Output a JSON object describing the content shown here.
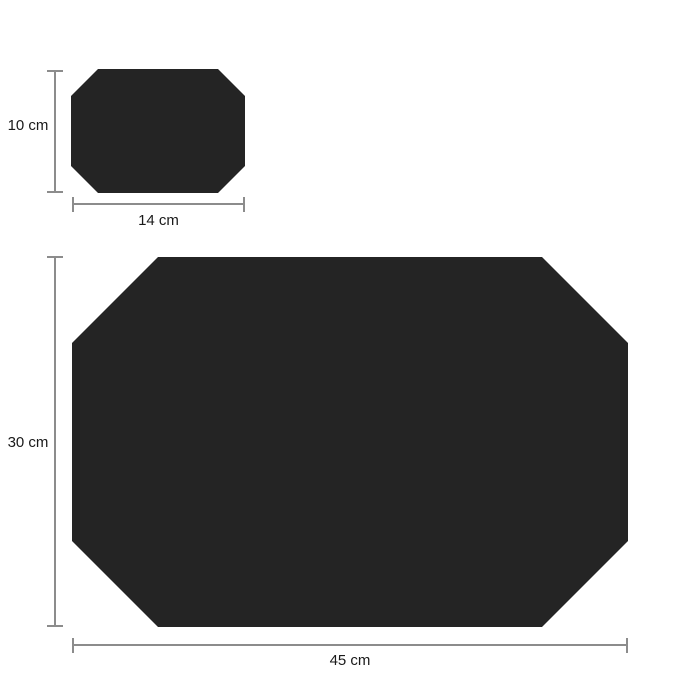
{
  "colors": {
    "background": "#ffffff",
    "shape_fill": "#242424",
    "dimension_line": "#8c8c8c",
    "label_text": "#1a1a1a"
  },
  "small_item": {
    "height_label": "10 cm",
    "width_label": "14 cm"
  },
  "large_item": {
    "height_label": "30 cm",
    "width_label": "45 cm"
  }
}
